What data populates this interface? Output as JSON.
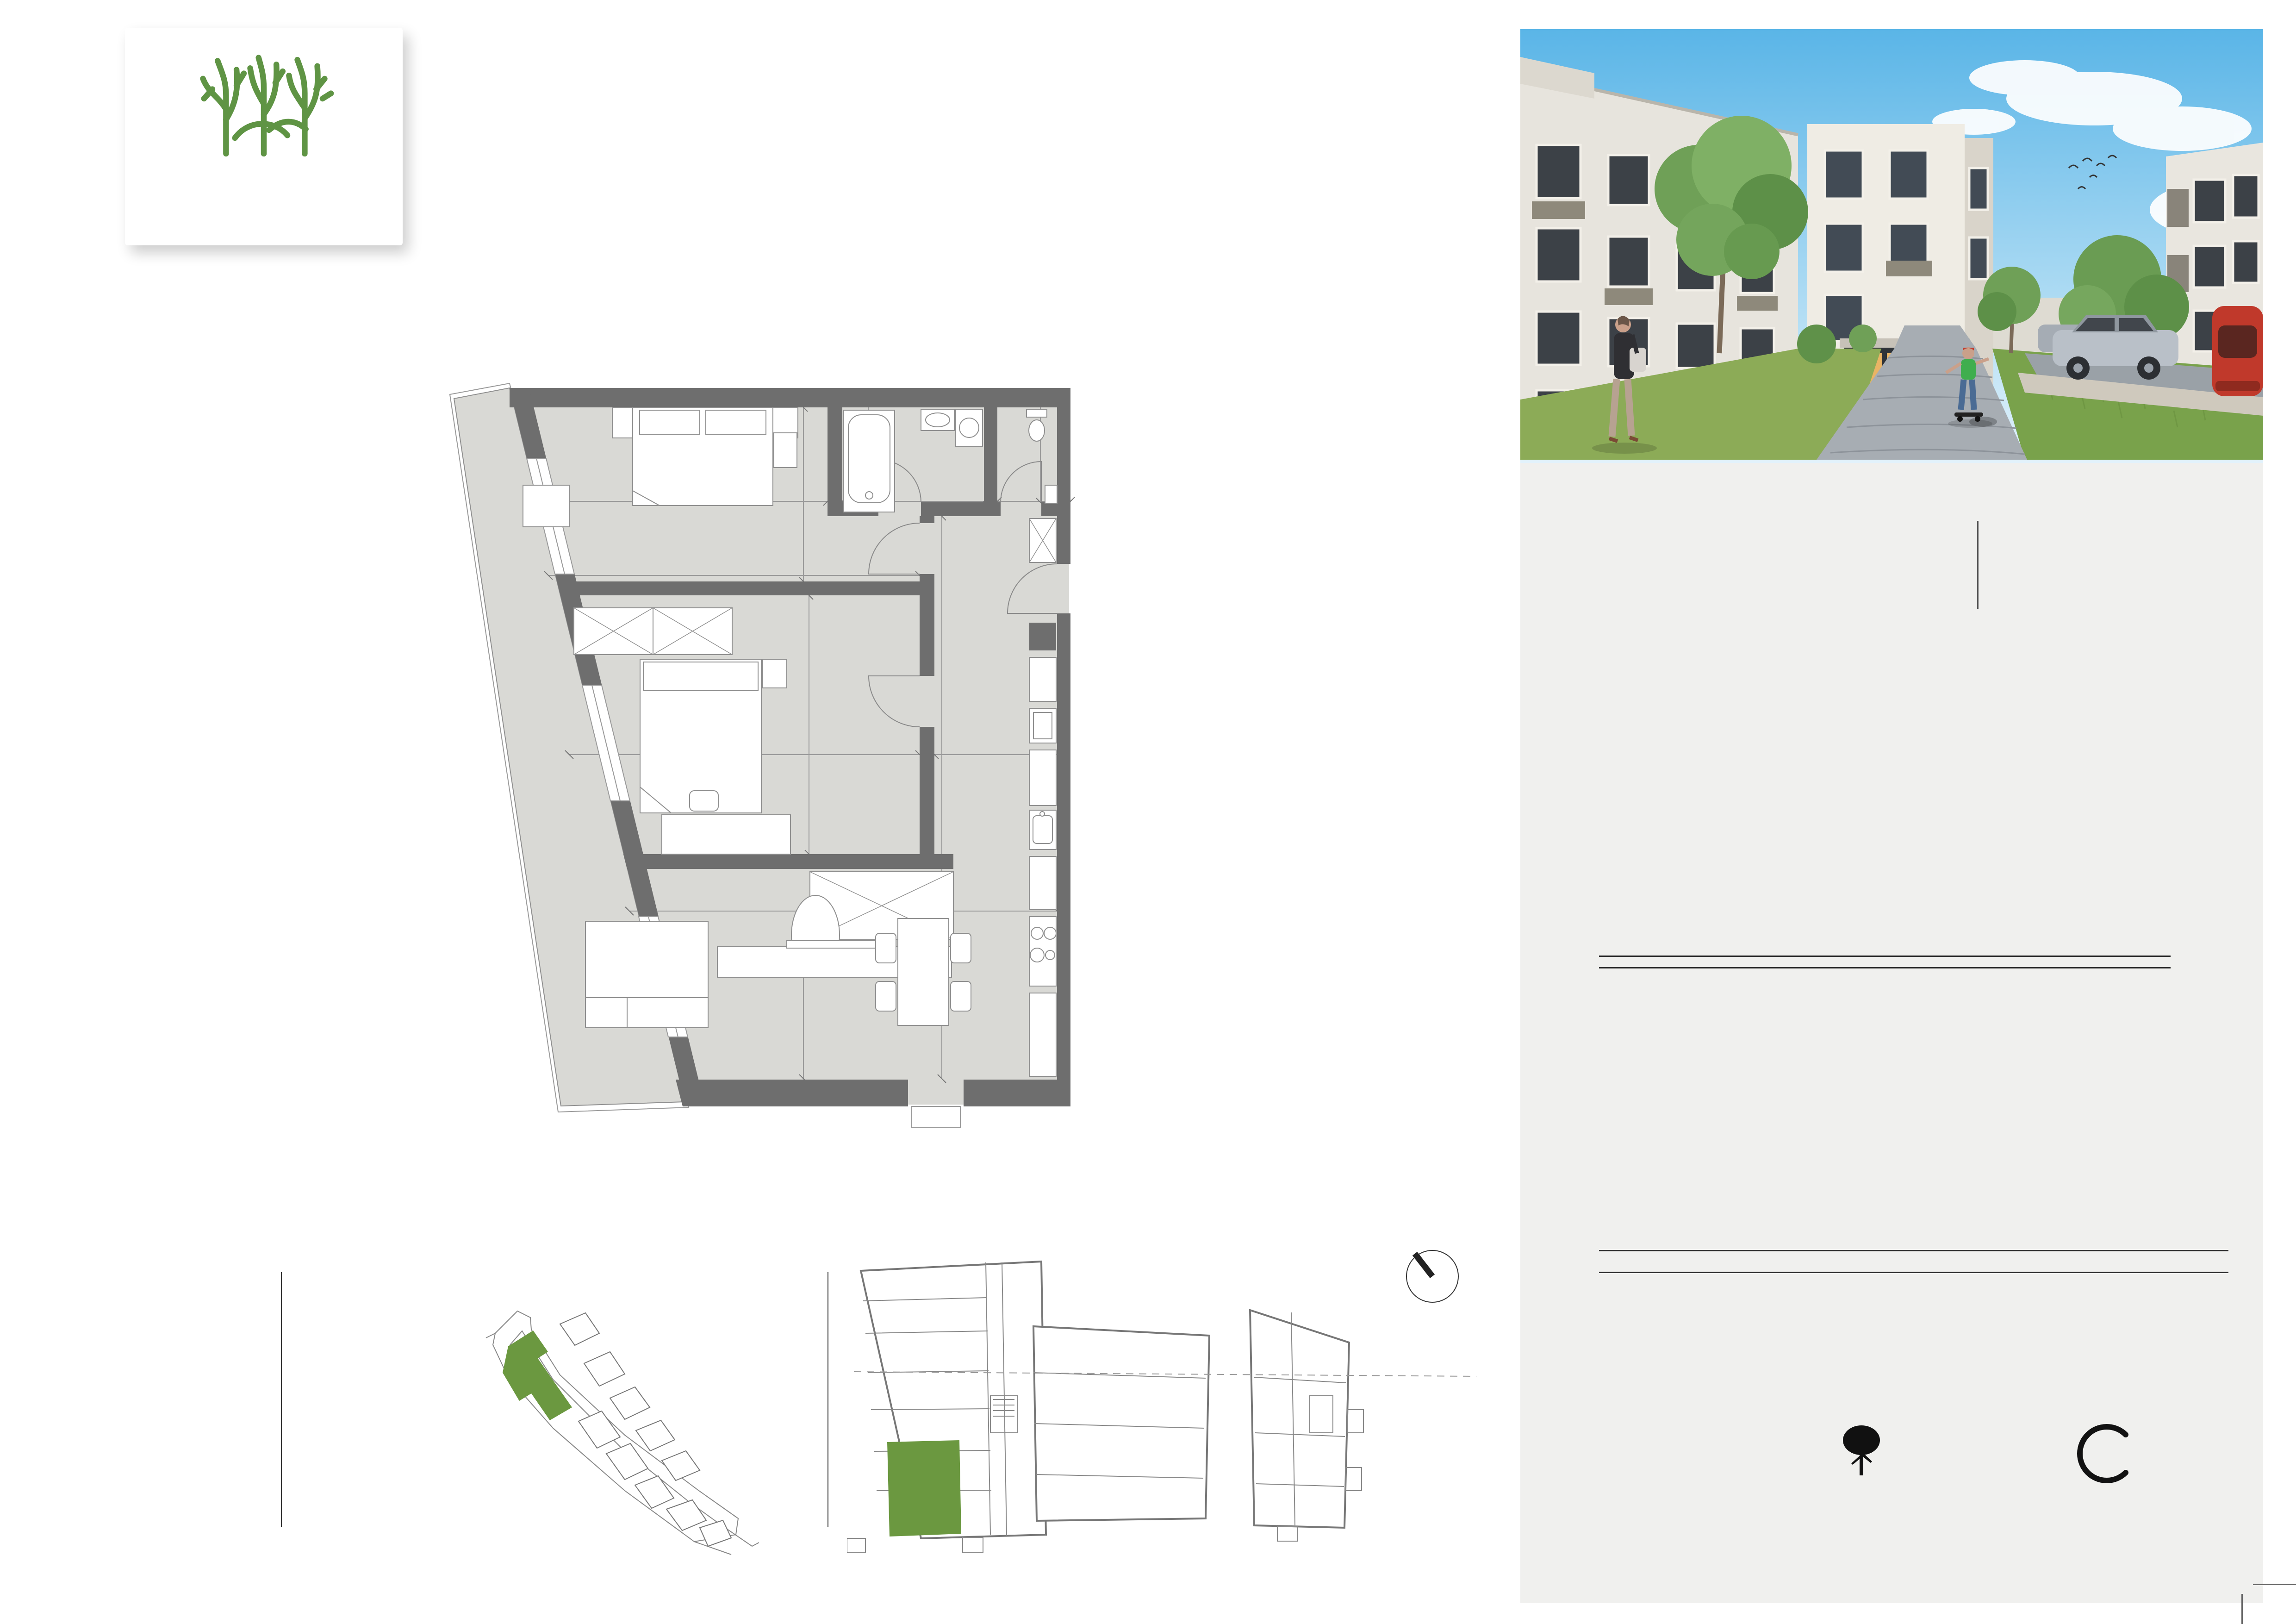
{
  "logo": {
    "brand": "BYTY DUO",
    "tagline": "moderné bývanie pre Vás"
  },
  "unit": {
    "id": "A1-00-02",
    "floor": "1. podzemné podlažie",
    "type": "3 - izbový byt"
  },
  "legend": {
    "title": "Legenda miestností",
    "rows": [
      {
        "num": "01.",
        "name": "chodba",
        "area": "9,80"
      },
      {
        "num": "02.",
        "name": "kuchyňa",
        "area": "10,81"
      },
      {
        "num": "03.",
        "name": "obývacia izba",
        "area": "20,80"
      },
      {
        "num": "04.",
        "name": "izba",
        "area": "12,69"
      },
      {
        "num": "05.",
        "name": "izba",
        "area": "16,25"
      },
      {
        "num": "06.",
        "name": "kúpeľňa",
        "area": "4,72"
      },
      {
        "num": "07.",
        "name": "toaleta",
        "area": "1,80"
      },
      {
        "num": "08.",
        "name": "terasa",
        "area": "21,90"
      }
    ],
    "total": "98,77 m²"
  },
  "plan": {
    "kitchen_label": "UR",
    "sink_symbol": "✳",
    "rooms": [
      {
        "label": "05."
      },
      {
        "label": "06."
      },
      {
        "label": "07."
      },
      {
        "label": "01."
      },
      {
        "label": "04."
      },
      {
        "label": "03."
      },
      {
        "label": "02."
      },
      {
        "label": "08."
      }
    ],
    "dims": [
      {
        "t": "3 898"
      },
      {
        "t": "3 800"
      },
      {
        "t": "150"
      },
      {
        "t": "2 300"
      },
      {
        "t": "2 050"
      },
      {
        "t": "1 635"
      },
      {
        "t": "1 100"
      },
      {
        "t": "150"
      },
      {
        "t": "150"
      },
      {
        "t": "150"
      },
      {
        "t": "4 870"
      },
      {
        "t": "2 700"
      },
      {
        "t": "4 844"
      },
      {
        "t": "150"
      },
      {
        "t": "2 200"
      },
      {
        "t": "150"
      },
      {
        "t": "9 300"
      },
      {
        "t": "6 883"
      },
      {
        "t": "4 700"
      }
    ]
  },
  "location": {
    "object_label": "Poloha objektu",
    "unit_label": "Poloha bytu"
  },
  "notes": [
    "Zariaďovacie predmety v byte ako je kuchynská linka, elektrické spotrebiče ako aj nábytok niesu súčasťou ceny bytu.",
    "Rozmiestnenie zariaďovacích predmetov je len ilustračné a umiestnenie prípojok na príslušné média v byte nemusia zodpovedať skutočnosti a budú realizované podľa projektovej dokumentácie.",
    "Uvedené zobrazenie a výmery sú predbežné a nemusia sa zhodovať s realizačným projektom."
  ],
  "contact": {
    "heading": "Predajné miesto:",
    "lines": [
      "Sabinovská 3, Prešov",
      "matus.mathis@bytyduo.sk",
      "tel.: 0903 514 462",
      "www.bytyduo.sk"
    ]
  },
  "partners": {
    "mathis": "MATHIS.",
    "mathis_sub": "REALITNÁ KANCELÁRIA",
    "pj": "pj.",
    "pj_lines": [
      "ateliér",
      "architektúra",
      "dizajn"
    ]
  },
  "colors": {
    "accent_green": "#679b41",
    "brand_brown": "#8a7265",
    "panel_gray": "#f0f0ee",
    "wall_gray": "#6e6e6e",
    "floor_gray": "#d9d9d5"
  }
}
